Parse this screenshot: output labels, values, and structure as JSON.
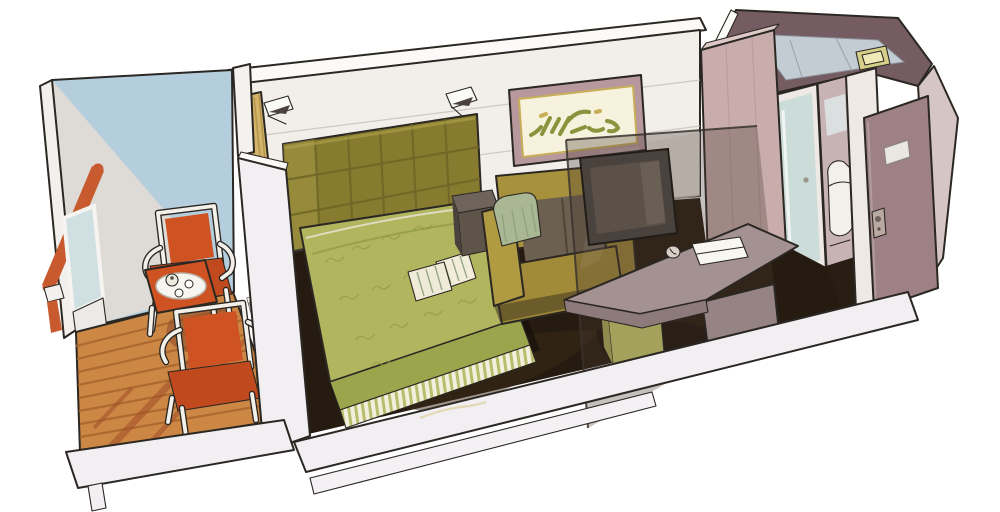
{
  "scene": {
    "type": "hand-drawn watercolor illustration",
    "subject": "cruise-ship balcony cabin cutaway",
    "description": "Perspective cutaway of a ship stateroom: private balcony with two orange armchairs and a coffee tray table on a wooden deck, double bed with olive quilted headboard and green bedspread, framed abstract artwork, mustard sofa, smoked-glass partition with TV, taupe desk with stool, wardrobe, bathroom with glass shower door, and open entrance door.",
    "rooms": [
      "balcony",
      "sleeping-area",
      "sitting-area",
      "desk-area",
      "bathroom",
      "entrance-hall"
    ],
    "objects": [
      "balcony handrail",
      "glass railing panel",
      "wooden deck",
      "two orange armchairs",
      "coffee table with serving tray",
      "sliding-door track",
      "privacy divider wall",
      "gold curtain",
      "two wall sconces",
      "quilted headboard",
      "double bed",
      "two striped accent pillows",
      "bed skirt",
      "nightstand",
      "light switch",
      "framed artwork",
      "sofa with bolster pillow",
      "smoked glass partition",
      "tv",
      "desk with notepad and telephone",
      "stool",
      "wardrobe",
      "shower glass door",
      "toilet",
      "entrance door with plaque and handle",
      "ceiling light fixture"
    ]
  },
  "palette": {
    "page_bg": "#ffffff",
    "ink": "#2b2723",
    "wall_white": "#f2efeb",
    "ceiling_band": "#fbfaf8",
    "wall_corner_shade": "#e4dfd8",
    "balcony_wall_blue": "#b5cedd",
    "balcony_wall_light": "#dedad5",
    "cut_edge_white": "#f1eff2",
    "handrail_orange": "#c75a2e",
    "railing_glass": "#cfdfe2",
    "deck_wood": "#cd8745",
    "chair_orange": "#cf5222",
    "chair_seat_orange": "#c04a1e",
    "curtain_gold": "#d4b468",
    "headboard_olive": "#867b2f",
    "bedspread_green": "#b1b55e",
    "bedspread_side": "#9aa54c",
    "pillow_cream": "#f0ebd8",
    "nightstand_brown": "#5e544a",
    "sofa_mustard": "#a8913c",
    "sofa_cushion_dark": "#6c6150",
    "sofa_pillow_sage": "#a9b795",
    "carpet_dark": "#251b10",
    "glass_smoke": "rgba(74,59,50,0.32)",
    "tv_dark": "#4a423c",
    "frame_mauve": "#b7999d",
    "frame_mat": "#f7f2de",
    "art_green": "#8b933c",
    "art_gold": "#c8ae58",
    "desk_taupe": "#a49191",
    "desk_front": "#8d7b7b",
    "stool_olive": "#a3a15b",
    "wardrobe_mauve": "#c9adad",
    "wardrobe_top": "#ddc9c8",
    "bath_interior": "#b89da0",
    "shower_glass": "#ccdcd8",
    "door_mauve": "#9d8184",
    "door_frame_white": "#efe9e5",
    "right_wall_mauve": "#d5c5c5",
    "ceiling_dark_mauve": "#755c63",
    "ceiling_glass_blue": "#c3ccd3",
    "fixture_yellow": "#d6cf8a",
    "tray_white": "#f7f5f0"
  }
}
